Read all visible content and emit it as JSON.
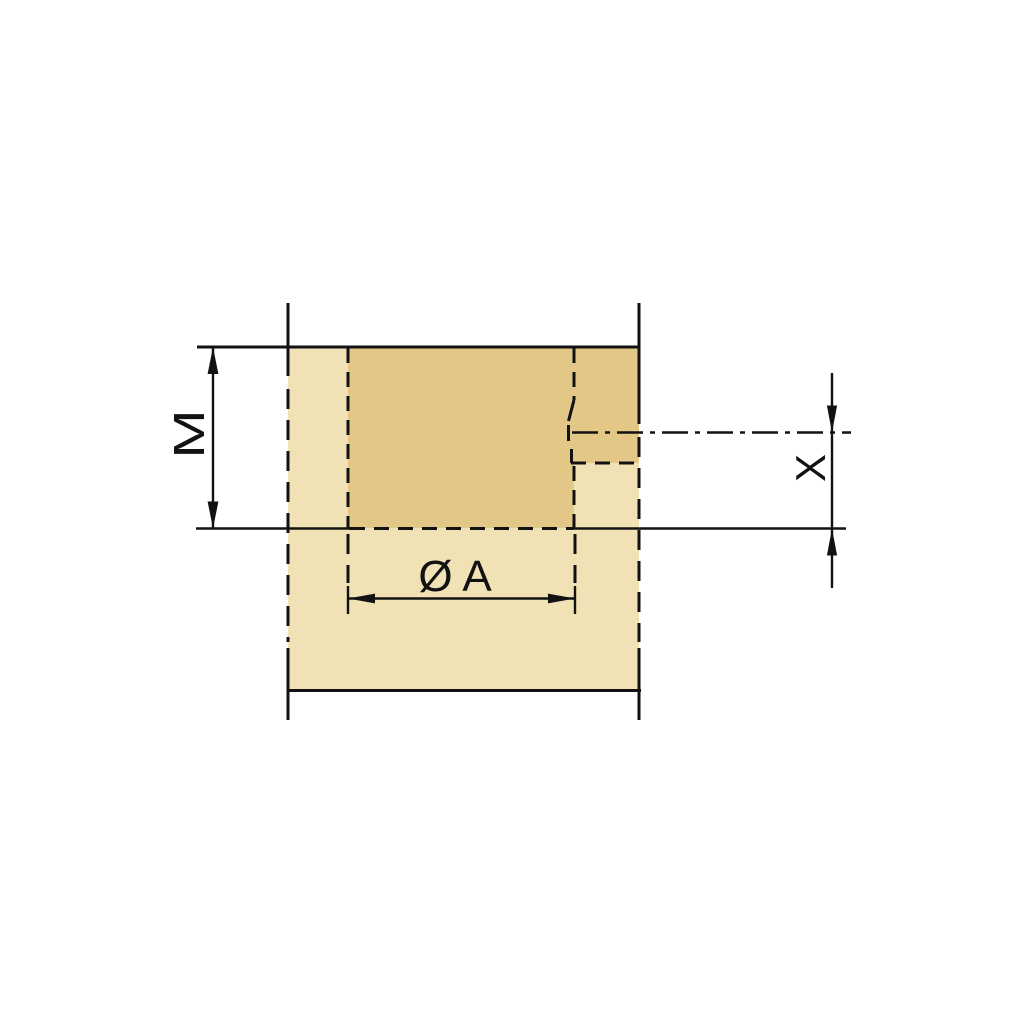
{
  "diagram": {
    "labels": {
      "depth": "M",
      "diameter": "Ø A",
      "edge_distance": "X"
    },
    "colors": {
      "background": "#ffffff",
      "panel_fill": "#f0e2b5",
      "bore_fill": "#e3c787",
      "line": "#121212"
    }
  }
}
